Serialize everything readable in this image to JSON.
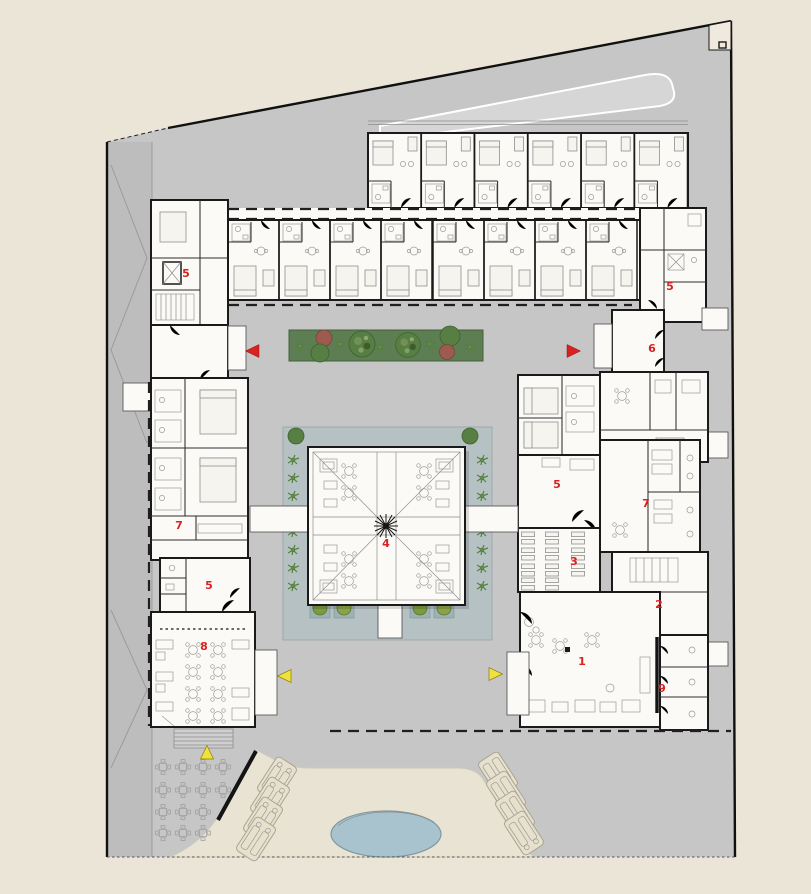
{
  "plan": {
    "description_markers_note": "red room-number annotations visible on the floor plan",
    "markers": [
      {
        "id": "room-1",
        "text": "1",
        "x": 582,
        "y": 665
      },
      {
        "id": "room-2",
        "text": "2",
        "x": 659,
        "y": 608
      },
      {
        "id": "room-3",
        "text": "3",
        "x": 574,
        "y": 565
      },
      {
        "id": "room-4",
        "text": "4",
        "x": 386,
        "y": 547
      },
      {
        "id": "room-5-west-core",
        "text": "5",
        "x": 186,
        "y": 277
      },
      {
        "id": "room-5-east-core",
        "text": "5",
        "x": 670,
        "y": 290
      },
      {
        "id": "room-5-east-wing",
        "text": "5",
        "x": 557,
        "y": 488
      },
      {
        "id": "room-5-west-wing",
        "text": "5",
        "x": 209,
        "y": 589
      },
      {
        "id": "room-6",
        "text": "6",
        "x": 652,
        "y": 352
      },
      {
        "id": "room-7-east",
        "text": "7",
        "x": 646,
        "y": 507
      },
      {
        "id": "room-7-west",
        "text": "7",
        "x": 179,
        "y": 529
      },
      {
        "id": "room-8",
        "text": "8",
        "x": 204,
        "y": 650
      },
      {
        "id": "room-9",
        "text": "9",
        "x": 662,
        "y": 692
      }
    ],
    "arrows": [
      {
        "id": "courtyard-entry-west",
        "color": "red",
        "dir": "left",
        "x": 253,
        "y": 351
      },
      {
        "id": "courtyard-entry-east",
        "color": "red",
        "dir": "right",
        "x": 573,
        "y": 351
      },
      {
        "id": "terrace-entry-west",
        "color": "yellow",
        "dir": "left",
        "x": 285,
        "y": 676
      },
      {
        "id": "lobby-entry-east",
        "color": "yellow",
        "dir": "right",
        "x": 495,
        "y": 674
      },
      {
        "id": "steps-entry-south",
        "color": "yellow",
        "dir": "up",
        "x": 207,
        "y": 753
      }
    ],
    "arrow_colors": {
      "red": "#d92121",
      "yellow": "#efe23c"
    }
  },
  "colors": {
    "background": "#eae5d7",
    "site": "#c6c6c6",
    "road_strip": "#bdbdbd",
    "building": "#fbfaf6",
    "wall": "#1a1a1a",
    "canopy": "#d6d6d6",
    "water": "#b6c1c3",
    "planter": "#9db2b4",
    "plant_green": "#55803f",
    "tree_red": "#9d5b50",
    "pool": "#a9c3ce",
    "plaza": "#e8e3d2",
    "marker_red": "#d92121",
    "arrow_yellow": "#efe23c"
  }
}
